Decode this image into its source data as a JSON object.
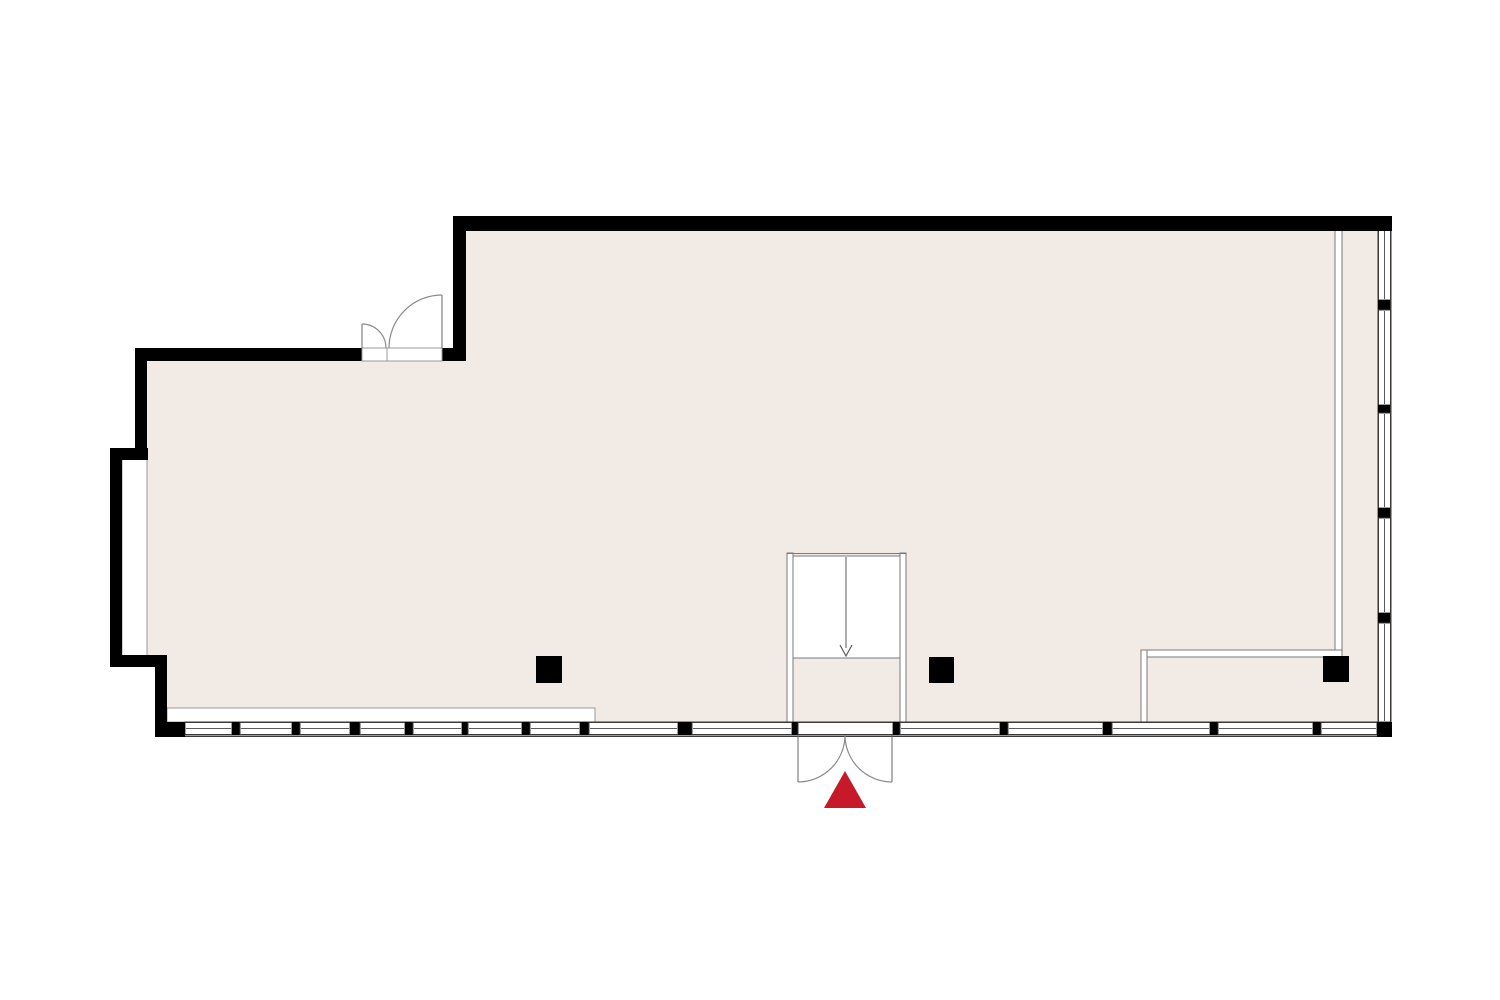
{
  "meta": {
    "title": "floor-plan"
  },
  "colors": {
    "background": "#ffffff",
    "floor": "#f2eae4",
    "wall": "#000000",
    "band_line": "#3a3a3a",
    "glazing_line": "#5a5a5a",
    "partition_line": "#7a7a7a",
    "door_arc": "#8a8a8a",
    "door_panel": "#666666",
    "sill_line": "#999999",
    "entrance_marker": "#c61a2b"
  },
  "plan": {
    "canvas": {
      "width": 1500,
      "height": 1000
    },
    "floor": {
      "name": "floor-area",
      "points": "146,354 459,354 459,224 1386,224 1386,731 162,731 162,662 146,662"
    },
    "white_patches": [
      {
        "name": "left-window-niche",
        "x": 122,
        "y": 458,
        "w": 25,
        "h": 200
      },
      {
        "name": "interior-sill-strip",
        "x": 167,
        "y": 708,
        "w": 428,
        "h": 14
      }
    ],
    "partitions": [
      {
        "name": "partition-right-vertical",
        "x": 1335,
        "y": 230,
        "w": 7,
        "h": 421
      },
      {
        "name": "partition-bottom-horizontal",
        "x": 1141,
        "y": 650,
        "w": 201,
        "h": 7
      },
      {
        "name": "partition-bottom-vertical",
        "x": 1141,
        "y": 650,
        "w": 6,
        "h": 72
      },
      {
        "name": "vestibule-wall-left",
        "x": 787,
        "y": 553,
        "w": 6,
        "h": 169
      },
      {
        "name": "vestibule-wall-right",
        "x": 900,
        "y": 553,
        "w": 6,
        "h": 169
      }
    ],
    "window_band_bottom": {
      "name": "window-band-bottom",
      "y": 722,
      "h": 13,
      "x1": 185,
      "x2": 1377,
      "glazing_y": 728.5,
      "outer_line_y": 736.5,
      "segments": [
        [
          "w",
          185,
          232
        ],
        [
          "m",
          232,
          240
        ],
        [
          "w",
          240,
          292
        ],
        [
          "m",
          292,
          300
        ],
        [
          "w",
          300,
          350
        ],
        [
          "m",
          350,
          360
        ],
        [
          "w",
          360,
          405
        ],
        [
          "m",
          405,
          413
        ],
        [
          "w",
          413,
          462
        ],
        [
          "m",
          462,
          468
        ],
        [
          "w",
          468,
          522
        ],
        [
          "m",
          522,
          530
        ],
        [
          "w",
          530,
          580
        ],
        [
          "m",
          580,
          589
        ],
        [
          "w",
          589,
          678
        ],
        [
          "m",
          678,
          692
        ],
        [
          "w",
          692,
          792
        ],
        [
          "m",
          792,
          798
        ],
        [
          "d",
          798,
          893
        ],
        [
          "m",
          893,
          900
        ],
        [
          "w",
          900,
          1000
        ],
        [
          "m",
          1000,
          1008
        ],
        [
          "w",
          1008,
          1103
        ],
        [
          "m",
          1103,
          1112
        ],
        [
          "w",
          1112,
          1210
        ],
        [
          "m",
          1210,
          1218
        ],
        [
          "w",
          1218,
          1313
        ],
        [
          "m",
          1313,
          1321
        ],
        [
          "w",
          1321,
          1377
        ]
      ]
    },
    "window_band_right": {
      "name": "window-band-right",
      "x": 1378,
      "w": 13,
      "y1": 230,
      "y2": 722,
      "glazing_x": 1384.5,
      "outer_line_x": 1390.5,
      "segments": [
        [
          "w",
          230,
          300
        ],
        [
          "m",
          300,
          310
        ],
        [
          "w",
          310,
          405
        ],
        [
          "m",
          405,
          413
        ],
        [
          "w",
          413,
          508
        ],
        [
          "m",
          508,
          518
        ],
        [
          "w",
          518,
          613
        ],
        [
          "m",
          613,
          623
        ],
        [
          "w",
          623,
          722
        ]
      ]
    },
    "walls": [
      {
        "name": "wall-top",
        "x": 453,
        "y": 216,
        "w": 939,
        "h": 15
      },
      {
        "name": "wall-notch-vertical",
        "x": 453,
        "y": 216,
        "w": 13,
        "h": 145
      },
      {
        "name": "wall-upper-left-horizontal",
        "x": 135,
        "y": 348,
        "w": 227,
        "h": 13
      },
      {
        "name": "wall-top-door-stub",
        "x": 442,
        "y": 348,
        "w": 24,
        "h": 13
      },
      {
        "name": "wall-left-vertical",
        "x": 135,
        "y": 348,
        "w": 12,
        "h": 102
      },
      {
        "name": "wall-step-top",
        "x": 110,
        "y": 448,
        "w": 38,
        "h": 12
      },
      {
        "name": "wall-outer-left-vertical",
        "x": 110,
        "y": 448,
        "w": 12,
        "h": 219
      },
      {
        "name": "wall-step-bottom",
        "x": 110,
        "y": 655,
        "w": 57,
        "h": 12
      },
      {
        "name": "wall-lower-left-vertical",
        "x": 155,
        "y": 655,
        "w": 12,
        "h": 82
      },
      {
        "name": "wall-bottom-left-corner",
        "x": 155,
        "y": 722,
        "w": 30,
        "h": 15
      },
      {
        "name": "wall-bottom-right-corner",
        "x": 1377,
        "y": 722,
        "w": 15,
        "h": 15
      }
    ],
    "columns": [
      {
        "name": "column-left",
        "x": 536,
        "y": 656,
        "w": 26,
        "h": 27
      },
      {
        "name": "column-middle",
        "x": 929,
        "y": 657,
        "w": 25,
        "h": 26
      },
      {
        "name": "column-right",
        "x": 1323,
        "y": 656,
        "w": 26,
        "h": 26
      }
    ],
    "stair": {
      "name": "stair-vestibule",
      "void": {
        "x": 793,
        "y": 556,
        "w": 107,
        "h": 102
      },
      "top_line": [
        787,
        553.5,
        906,
        553.5
      ],
      "center_line": [
        846,
        557,
        846,
        648
      ],
      "arrow_points": "840,645 846,656 852,645"
    },
    "doors": [
      {
        "name": "double-door-top",
        "sill": {
          "x": 362,
          "y": 348,
          "w": 80,
          "h": 13
        },
        "divider": [
          387,
          348,
          387,
          361
        ],
        "panels": [
          [
            362,
            324,
            362,
            348
          ],
          [
            442,
            295,
            442,
            348
          ]
        ],
        "arcs": [
          "M 362 324 A 24 24 0 0 1 386 348",
          "M 442 295 A 53 53 0 0 0 389 348"
        ]
      },
      {
        "name": "entrance-double-door",
        "sill": null,
        "divider": null,
        "panels": [
          [
            798,
            735,
            798,
            782
          ],
          [
            892,
            735,
            892,
            782
          ]
        ],
        "arcs": [
          "M 845 735 A 47 47 0 0 1 798 782",
          "M 845 735 A 47 47 0 0 0 892 782"
        ]
      }
    ],
    "entrance_marker": {
      "name": "entrance-marker-triangle",
      "points": "845,771 866,808 824,808"
    }
  }
}
